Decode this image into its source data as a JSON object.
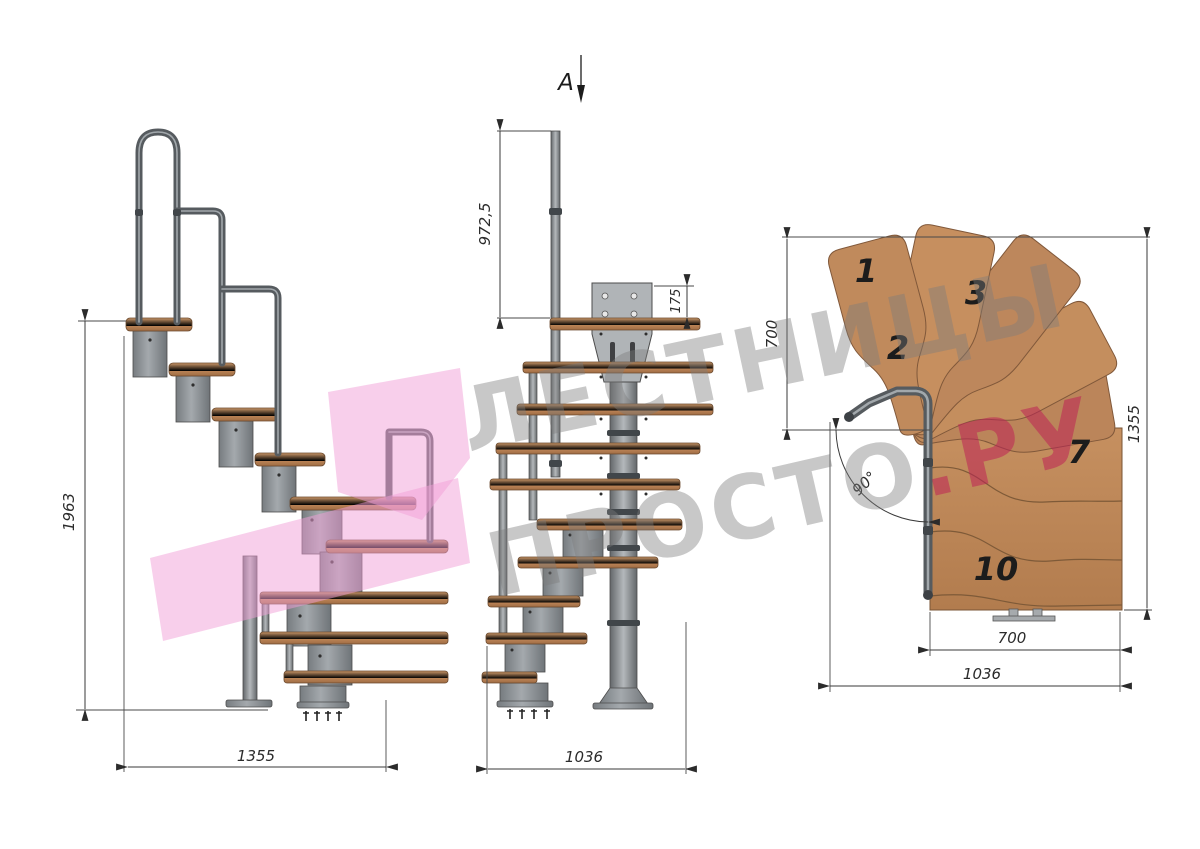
{
  "watermark": {
    "line1": "ЛЕСТНИЦЫ",
    "line2": "ПРОСТО",
    "accent": ".РУ"
  },
  "side_view": {
    "height_dim": "1963",
    "width_dim": "1355"
  },
  "front_view": {
    "section_label": "А",
    "rail_height_dim": "972,5",
    "plate_height_dim": "175",
    "width_dim": "1036"
  },
  "plan_view": {
    "flight_width_dim": "700",
    "depth_dim": "1355",
    "tread_width_dim": "700",
    "overall_width_dim": "1036",
    "angle_dim": "90°",
    "tread_numbers": [
      "1",
      "2",
      "3",
      "7",
      "10"
    ]
  },
  "colors": {
    "wood": "#c28c5e",
    "metal": "#9aa0a4",
    "handrail": "#565b5f",
    "dimension": "#3a3a3a",
    "watermark_grey": "#7d7d7d",
    "watermark_accent": "#be2355",
    "logo_pink": "#f2a0d7"
  }
}
